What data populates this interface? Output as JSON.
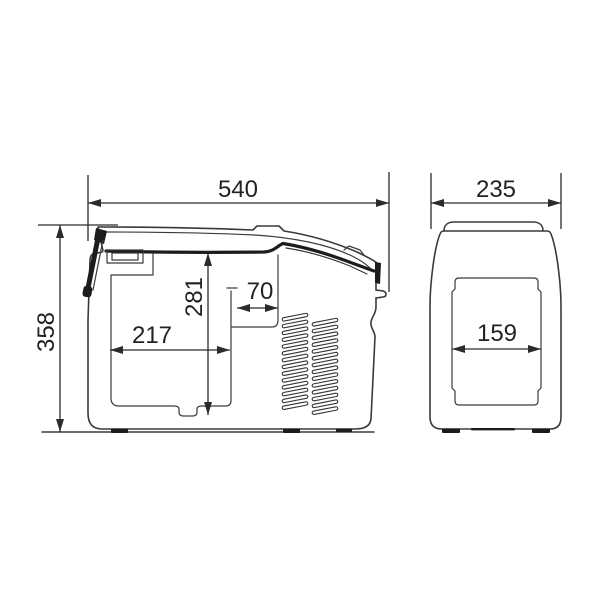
{
  "colors": {
    "background": "#ffffff",
    "drawing_line": "#3a3a3a",
    "dark_detail": "#1c1c1c",
    "dimension_line": "#2b2b2b",
    "dimension_text": "#222222"
  },
  "views": {
    "side": {
      "dims": {
        "overall_width": "540",
        "overall_height": "358",
        "inner_height": "281",
        "inner_length": "217",
        "step_width": "70"
      }
    },
    "end": {
      "dims": {
        "overall_depth": "235",
        "inner_width": "159"
      }
    }
  }
}
